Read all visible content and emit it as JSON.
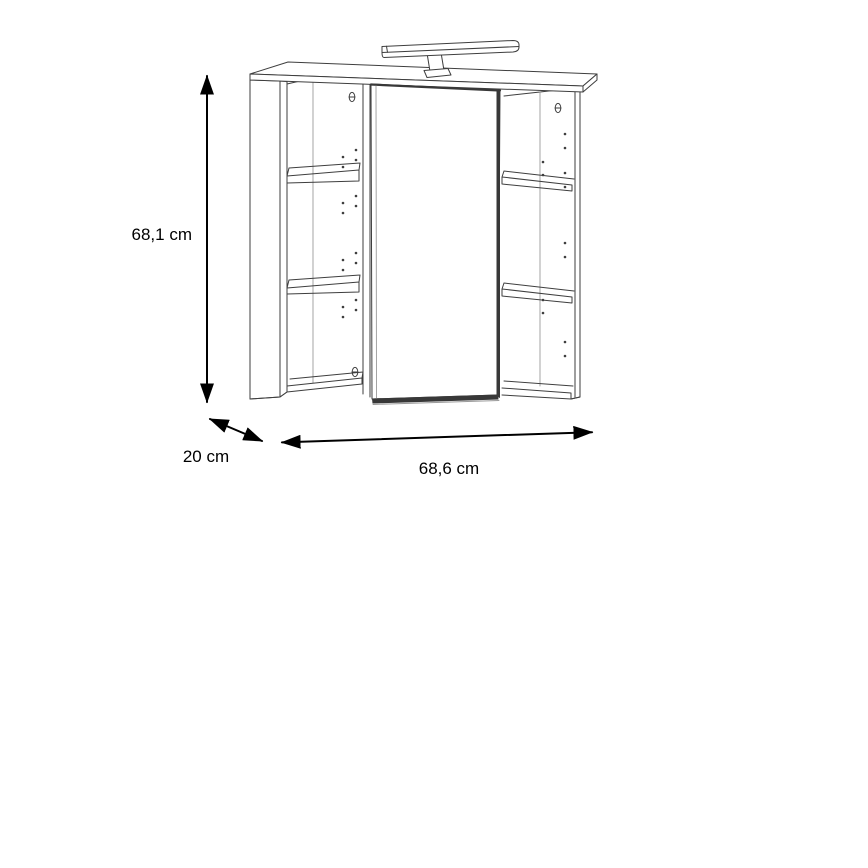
{
  "diagram": {
    "labels": {
      "height": "68,1 cm",
      "depth": "20 cm",
      "width": "68,6 cm"
    }
  },
  "colors": {
    "background": "#ffffff",
    "line": "#3e3e3e",
    "line_light": "#9a9a9a",
    "door_edge": "#383838",
    "arrow": "#000000",
    "text": "#000000"
  }
}
